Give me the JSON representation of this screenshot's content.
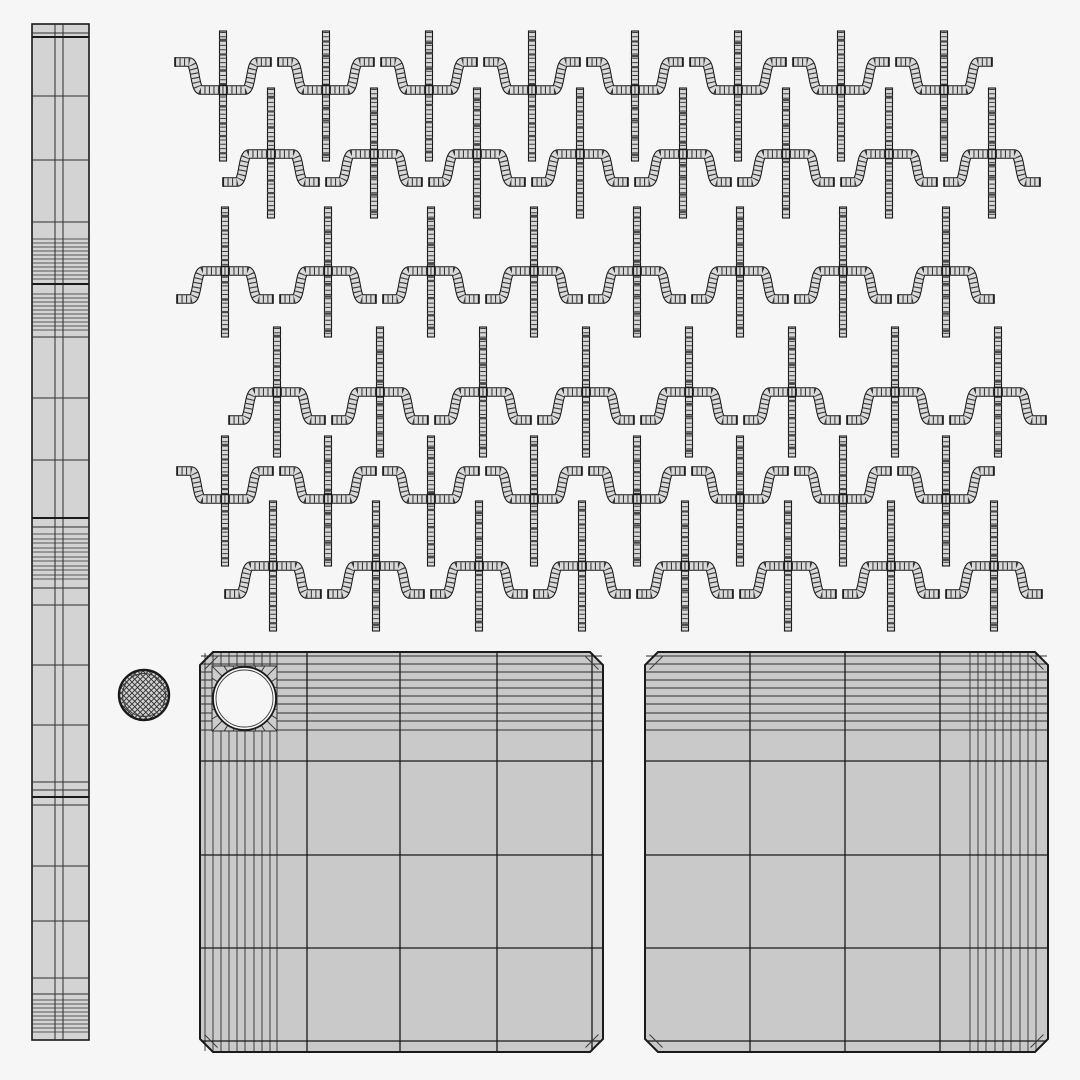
{
  "canvas": {
    "width": 1080,
    "height": 1080,
    "background": "#f6f6f6"
  },
  "colors": {
    "line": "#1a1a1a",
    "line_soft": "#3a3a3a",
    "line_dense": "#2e2e2e",
    "rod_fill": "#d3d3d3",
    "strip_fill": "#d7d7d7",
    "wave_fill": "#dadada",
    "panel_fill": "#c9c9c9",
    "block_fill": "#cccccc",
    "sphere_fill": "#d0d0d0",
    "hole_fill": "#f6f6f6",
    "dark_band": "#4a4a4a"
  },
  "rod": {
    "x": 32,
    "y": 24,
    "width": 57,
    "height": 1016,
    "inner_verticals": [
      55,
      63
    ],
    "lines": [
      [
        33,
        1
      ],
      [
        37,
        2
      ],
      [
        96,
        1
      ],
      [
        160,
        1
      ],
      [
        222,
        1
      ],
      [
        239,
        0.8
      ],
      [
        243,
        0.8
      ],
      [
        247,
        0.8
      ],
      [
        251,
        0.8
      ],
      [
        255,
        0.8
      ],
      [
        259,
        0.8
      ],
      [
        263,
        0.8
      ],
      [
        267,
        0.8
      ],
      [
        271,
        0.8
      ],
      [
        275,
        0.8
      ],
      [
        279,
        0.8
      ],
      [
        284,
        2
      ],
      [
        294,
        0.8
      ],
      [
        298,
        0.8
      ],
      [
        302,
        0.8
      ],
      [
        306,
        0.8
      ],
      [
        310,
        0.8
      ],
      [
        314,
        0.8
      ],
      [
        318,
        0.8
      ],
      [
        322,
        0.8
      ],
      [
        326,
        0.8
      ],
      [
        330,
        0.8
      ],
      [
        337,
        1
      ],
      [
        398,
        1
      ],
      [
        460,
        1
      ],
      [
        518,
        2
      ],
      [
        527,
        1
      ],
      [
        534,
        0.8
      ],
      [
        539,
        0.8
      ],
      [
        543,
        0.8
      ],
      [
        548,
        0.8
      ],
      [
        552,
        0.8
      ],
      [
        557,
        0.8
      ],
      [
        561,
        0.8
      ],
      [
        566,
        0.8
      ],
      [
        570,
        0.8
      ],
      [
        575,
        0.8
      ],
      [
        579,
        0.8
      ],
      [
        588,
        1
      ],
      [
        605,
        1
      ],
      [
        665,
        1
      ],
      [
        725,
        1
      ],
      [
        782,
        1
      ],
      [
        790,
        1
      ],
      [
        797,
        2
      ],
      [
        805,
        1
      ],
      [
        866,
        1
      ],
      [
        921,
        1
      ],
      [
        978,
        1
      ],
      [
        994,
        1
      ],
      [
        1000,
        0.8
      ],
      [
        1004,
        0.8
      ],
      [
        1008,
        0.8
      ],
      [
        1012,
        0.8
      ],
      [
        1016,
        0.8
      ],
      [
        1020,
        0.8
      ],
      [
        1024,
        0.8
      ],
      [
        1028,
        0.8
      ],
      [
        1032,
        0.8
      ]
    ]
  },
  "hook_pattern": {
    "unit_count": 8,
    "spacing": 103,
    "strip": {
      "width": 7,
      "height": 130
    },
    "wave": {
      "half_span": 48,
      "stub_end": 34,
      "flat_half": 22,
      "rise": 28,
      "thickness": 7.5,
      "outline": 9.6
    },
    "dark_band_fracs": [
      0.06,
      0.16,
      0.27,
      0.4,
      0.56,
      0.68,
      0.8,
      0.92
    ],
    "rows": [
      {
        "type": "valley",
        "x0": 223,
        "cross_y": 90,
        "strip_top": 31
      },
      {
        "type": "hat",
        "x0": 271,
        "cross_y": 154,
        "strip_top": 88
      },
      {
        "type": "hat",
        "x0": 225,
        "cross_y": 271,
        "strip_top": 207
      },
      {
        "type": "hat",
        "x0": 277,
        "cross_y": 392,
        "strip_top": 327
      },
      {
        "type": "valley",
        "x0": 225,
        "cross_y": 499,
        "strip_top": 436
      },
      {
        "type": "hat",
        "x0": 273,
        "cross_y": 566,
        "strip_top": 501
      }
    ]
  },
  "sphere": {
    "cx": 144,
    "cy": 695,
    "r": 25,
    "inner_r": 21.5,
    "hatch_spacing": 5.5
  },
  "panels": [
    {
      "x": 200,
      "y": 652,
      "width": 403,
      "height": 400,
      "chamfer": 13,
      "v_lines": [
        307,
        400,
        497,
        592
      ],
      "h_lines": [
        761,
        855,
        948,
        1041
      ],
      "dense_v": [
        205,
        213,
        221,
        229,
        237,
        245,
        254,
        262,
        270,
        277
      ],
      "dense_h": [
        656,
        664,
        672,
        680,
        688,
        696,
        704,
        713,
        721,
        730
      ],
      "hole": {
        "cx": 244.5,
        "cy": 698.5,
        "r": 31.5,
        "block": [
          212,
          666,
          65,
          65
        ],
        "spokes": 28
      }
    },
    {
      "x": 645,
      "y": 652,
      "width": 403,
      "height": 400,
      "chamfer": 13,
      "v_lines": [
        750,
        845,
        940
      ],
      "h_lines": [
        761,
        855,
        948,
        1041
      ],
      "dense_v": [
        970,
        978,
        986,
        995,
        1003,
        1011,
        1020,
        1028,
        1036
      ],
      "dense_h": [
        656,
        664,
        672,
        680,
        688,
        696,
        704,
        713,
        721,
        730
      ],
      "hole": null
    }
  ]
}
